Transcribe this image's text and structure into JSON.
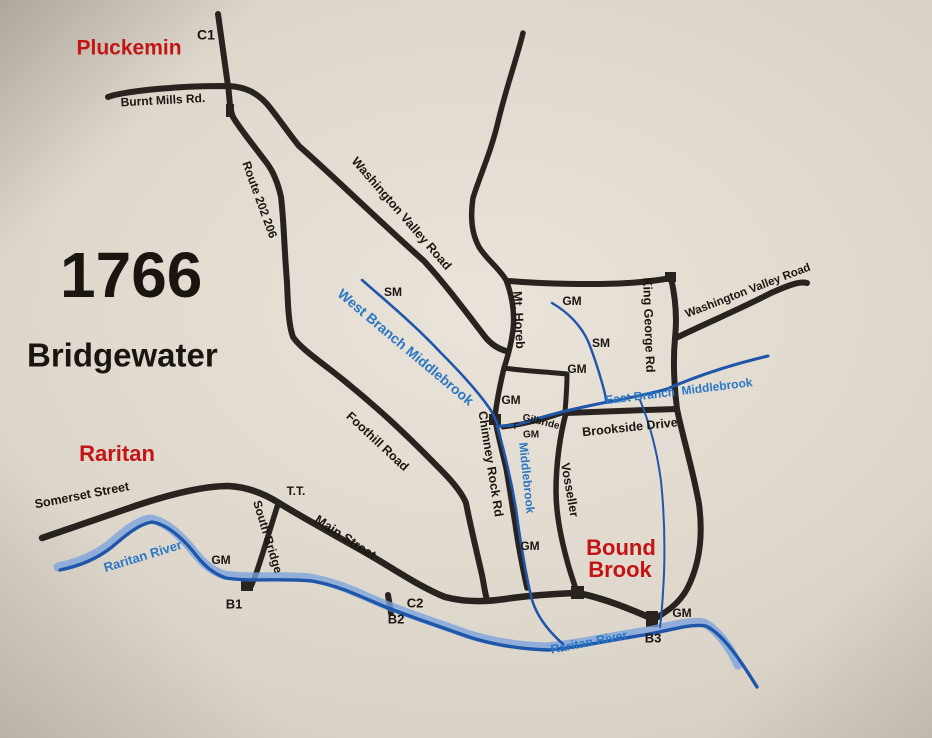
{
  "title": {
    "year": "1766",
    "town": "Bridgewater"
  },
  "places": {
    "pluckemin": "Pluckemin",
    "raritan": "Raritan",
    "bound_brook_line1": "Bound",
    "bound_brook_line2": "Brook"
  },
  "roads": {
    "burnt_mills": "Burnt Mills Rd.",
    "route_202_206": "Route 202 206",
    "washington_valley_center": "Washington Valley Road",
    "washington_valley_east": "Washington Valley Road",
    "mt_horeb": "Mt. Horeb",
    "king_george": "King George Rd",
    "gilbride": "Gilbride",
    "brookside": "Brookside Drive",
    "foothill": "Foothill Road",
    "chimney_rock": "Chimney Rock Rd",
    "vosseller": "Vosseller",
    "main_street": "Main Street",
    "somerset": "Somerset Street",
    "south_bridge": "South Bridge",
    "tt": "T.T."
  },
  "waterways": {
    "west_branch": "West Branch Middlebrook",
    "east_branch": "East Branch  Middlebrook",
    "middlebrook": "Middlebrook",
    "raritan_river": "Raritan River"
  },
  "markers": {
    "c1": "C1",
    "c2": "C2",
    "b1": "B1",
    "b2": "B2",
    "b3": "B3",
    "gm": "GM",
    "sm": "SM",
    "f": "F"
  },
  "colors": {
    "road": "#29231f",
    "water": "#2056aa",
    "water_light": "#7aa3dc",
    "water_label": "#2b77c4",
    "place_label": "#c41414",
    "ink": "#1b1510",
    "paper": "#ded7cc"
  }
}
